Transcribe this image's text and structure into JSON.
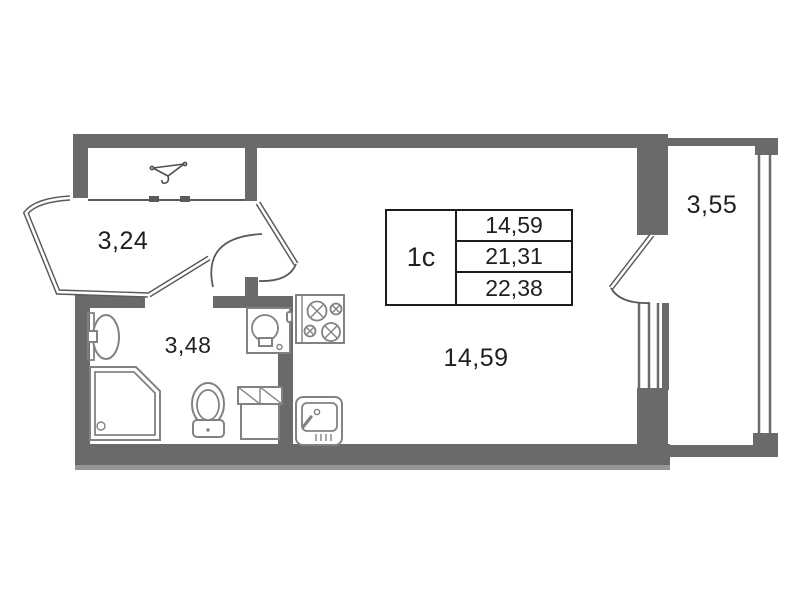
{
  "meta": {
    "type": "apartment-floor-plan",
    "style": "studio"
  },
  "area_table": {
    "unit": "1с",
    "values": [
      "14,59",
      "21,31",
      "22,38"
    ]
  },
  "rooms": {
    "hallway": {
      "area": "3,24"
    },
    "bathroom": {
      "area": "3,48"
    },
    "living_room": {
      "area": "14,59"
    },
    "balcony": {
      "area": "3,55"
    }
  },
  "icons": [
    "wardrobe-hanger-icon",
    "room-door-arc",
    "bathroom-door-arc",
    "balcony-door-arc",
    "bathroom-sink-icon",
    "shower-cabin-icon",
    "toilet-icon",
    "washing-machine-icon",
    "storage-cabinet-icon",
    "stove-icon",
    "kitchen-sink-icon",
    "window-glazing",
    "balcony-glazing"
  ],
  "colors": {
    "wall": "#6a6a6a",
    "wall_shadow": "#969696",
    "partition": "#5a5a5a",
    "fixture": "#828282",
    "text": "#1f1f1f",
    "table_border": "#1c1c1c",
    "background": "#ffffff"
  }
}
